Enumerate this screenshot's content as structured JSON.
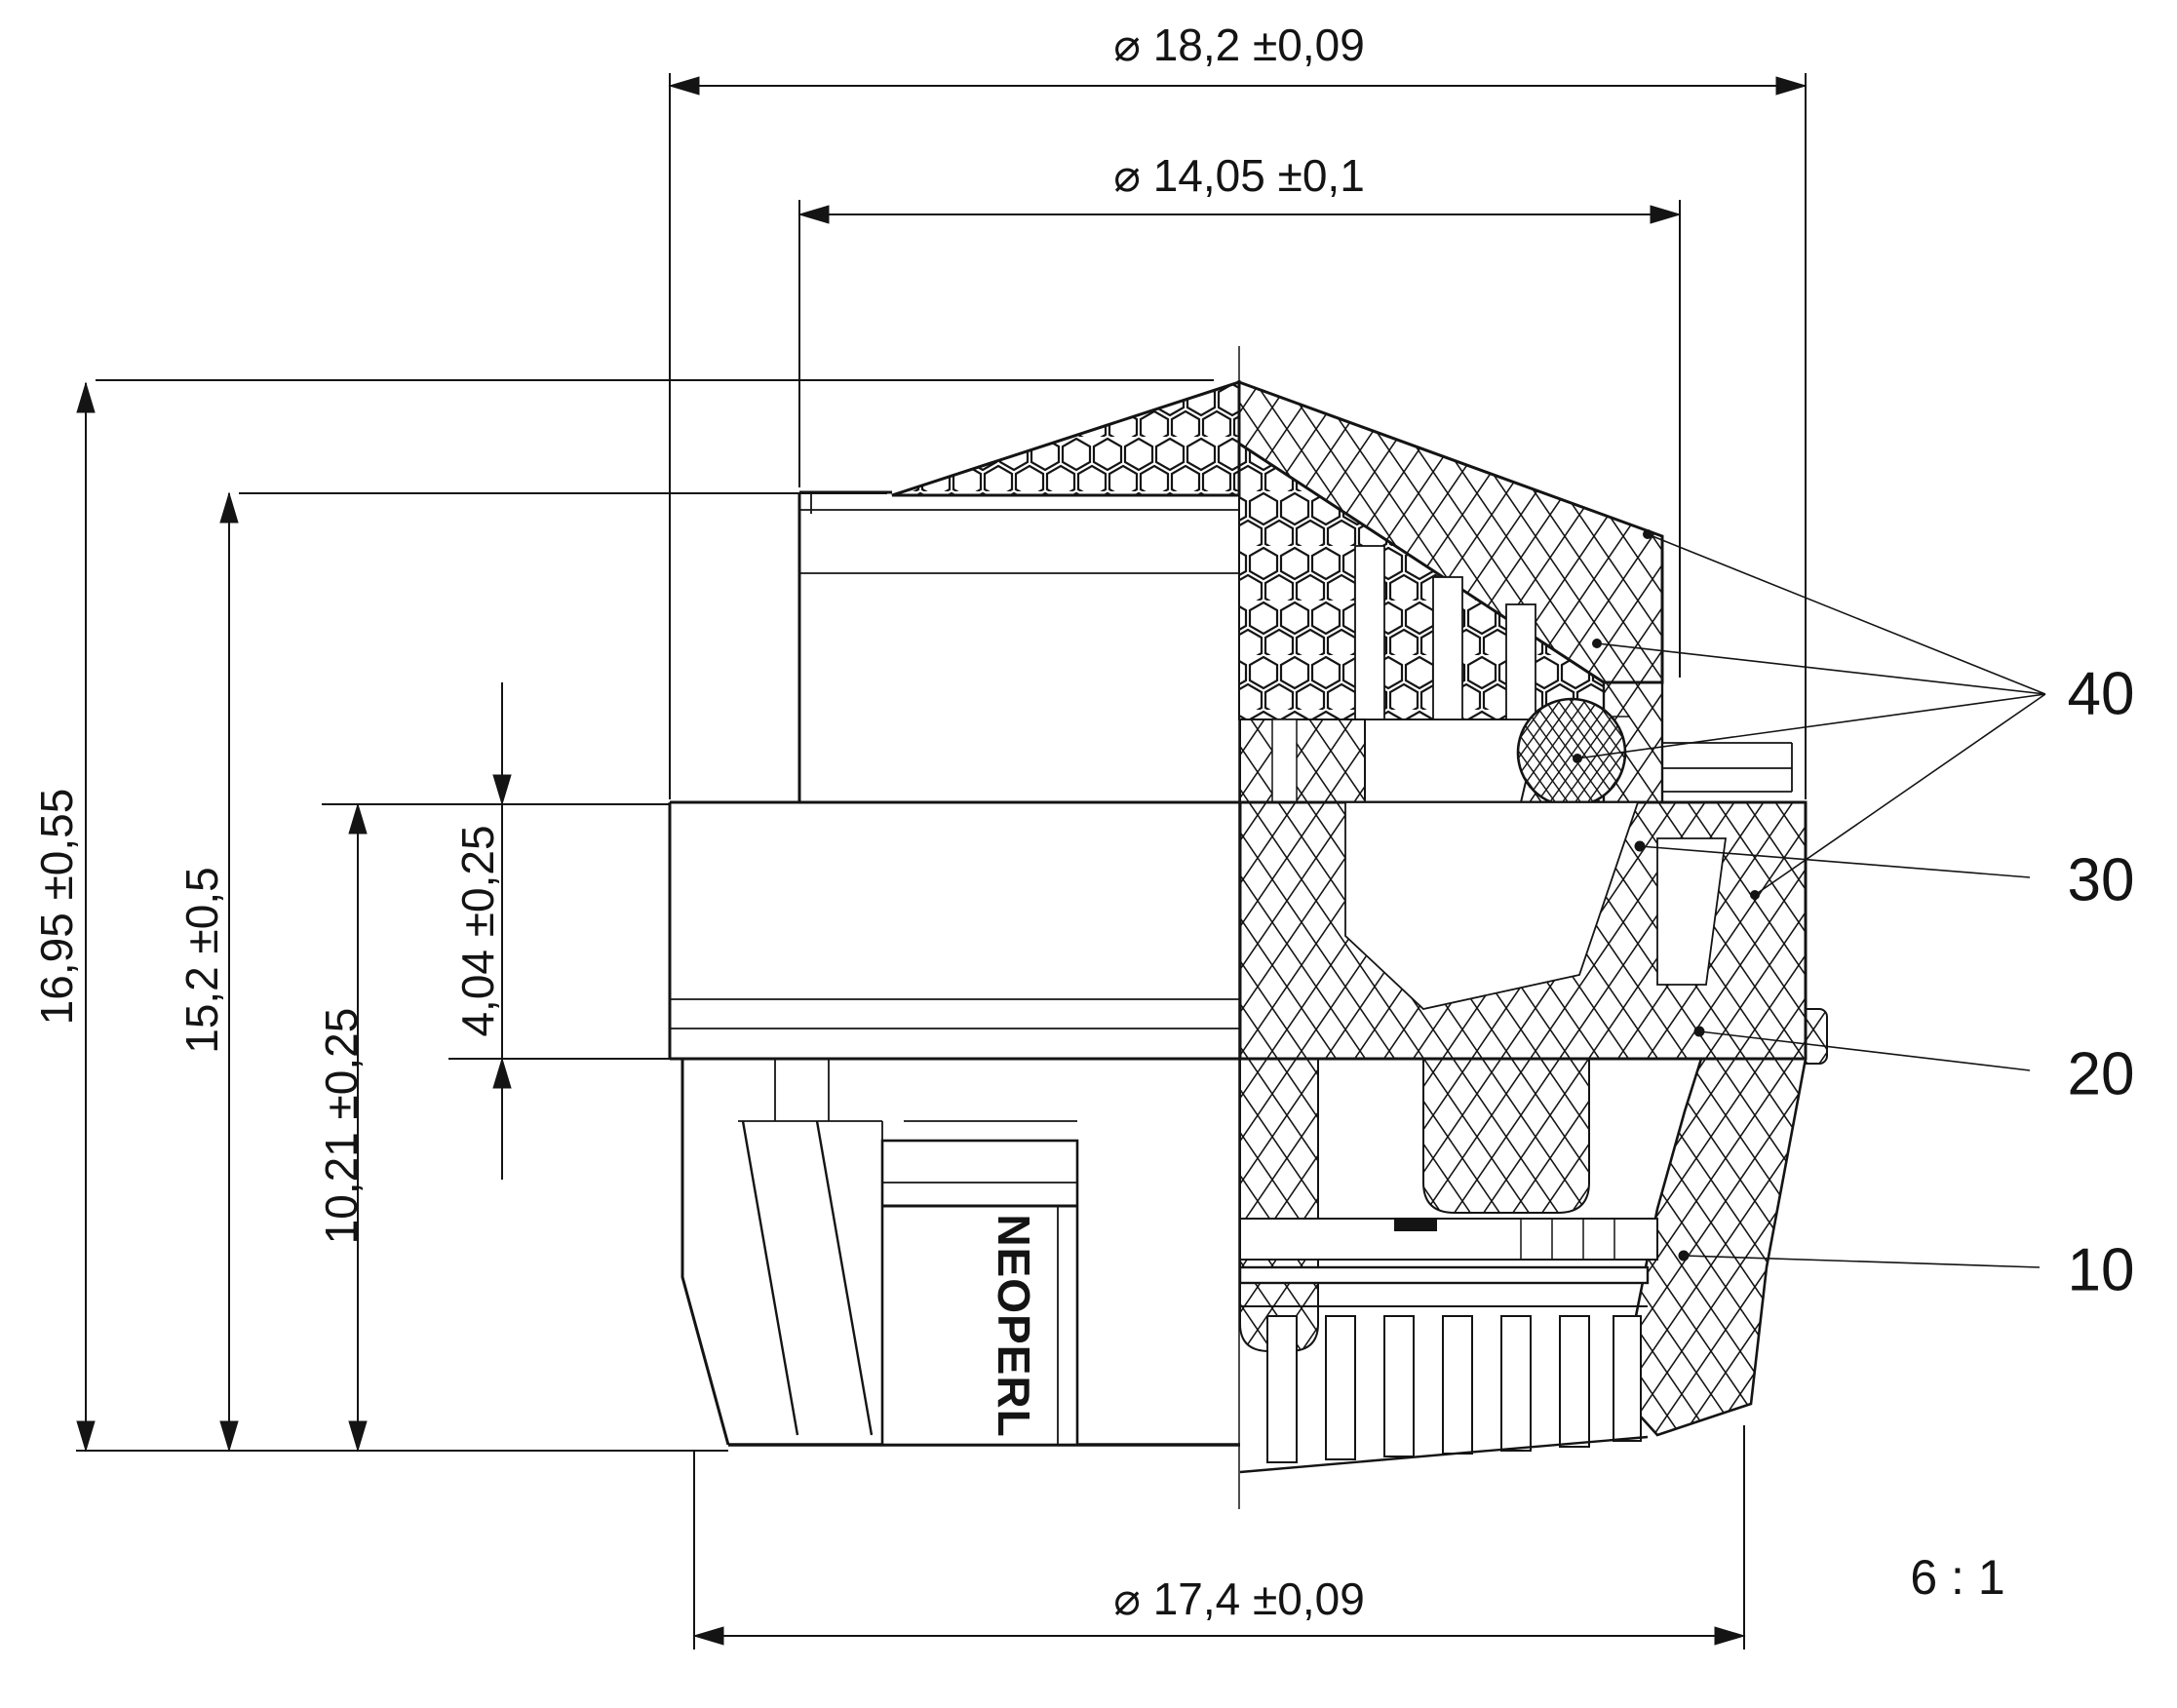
{
  "drawing": {
    "brand_label": "NEOPERL",
    "scale_label": "6 : 1",
    "dimensions": {
      "outer_diameter_top": "⌀ 18,2 ±0,09",
      "inner_diameter_top": "⌀ 14,05 ±0,1",
      "outer_diameter_bottom": "⌀ 17,4 ±0,09",
      "height_total": "16,95 ±0,55",
      "height_upper": "15,2 ±0,5",
      "height_lower": "10,21 ±0,25",
      "height_flange": "4,04 ±0,25"
    },
    "callouts": {
      "item_40": "40",
      "item_30": "30",
      "item_20": "20",
      "item_10": "10"
    },
    "line_color": "#141414",
    "background": "#ffffff"
  }
}
